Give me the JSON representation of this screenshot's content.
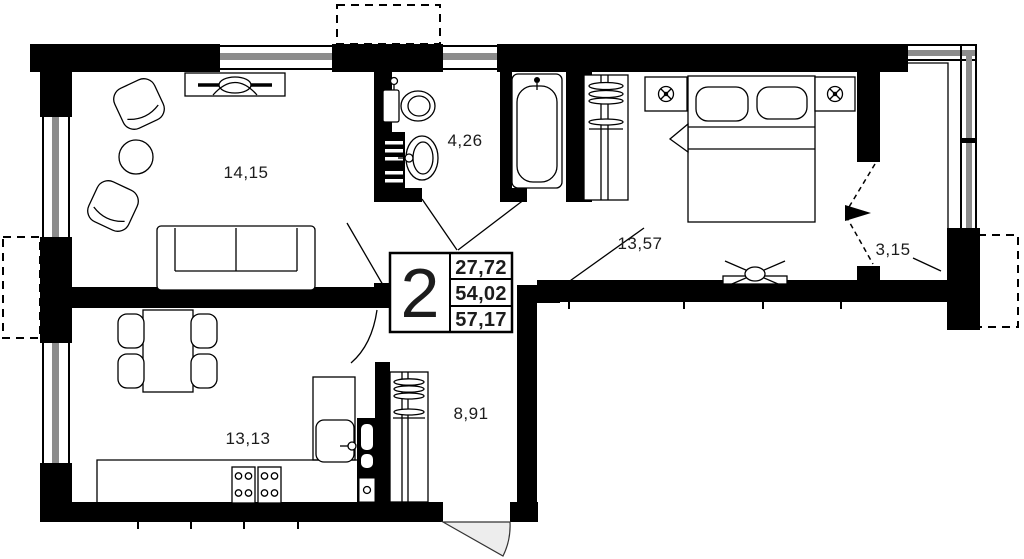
{
  "floor_plan": {
    "unit": {
      "number": "2",
      "areas": [
        "27,72",
        "54,02",
        "57,17"
      ]
    },
    "room_labels": {
      "living": "14,15",
      "bathroom": "4,26",
      "bedroom": "13,57",
      "balcony": "3,15",
      "kitchen": "13,13",
      "hallway": "8,91"
    },
    "colors": {
      "wall": "#000000",
      "window_glass": "#8c8c8c",
      "door_swing_fill": "#ededed"
    }
  }
}
